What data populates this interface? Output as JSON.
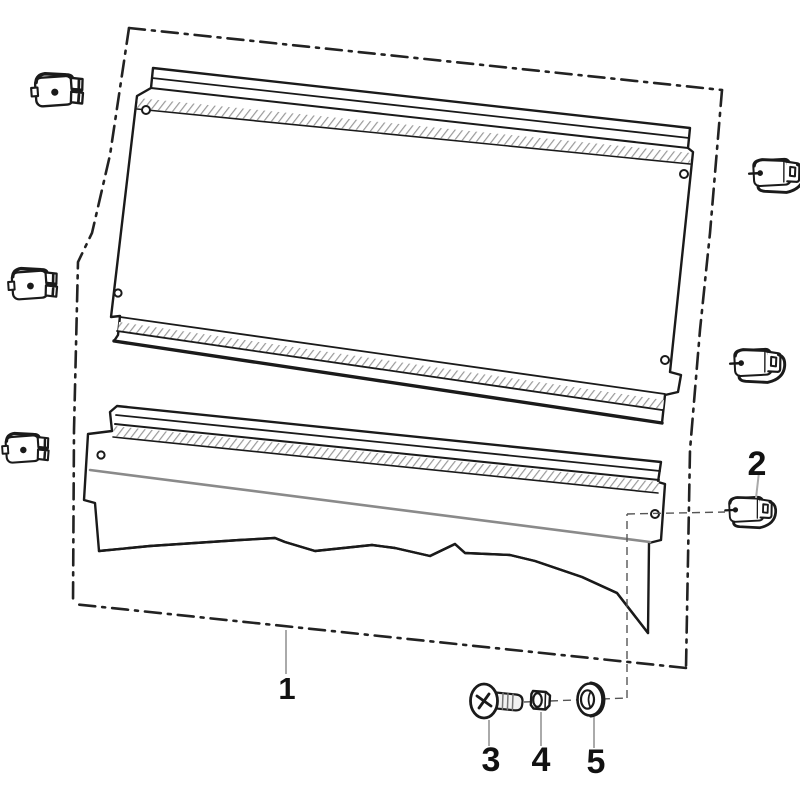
{
  "diagram": {
    "kind": "exploded-parts-diagram",
    "callouts": [
      {
        "id": "part-1",
        "label": "1"
      },
      {
        "id": "part-2",
        "label": "2"
      },
      {
        "id": "part-3",
        "label": "3"
      },
      {
        "id": "part-4",
        "label": "4"
      },
      {
        "id": "part-5",
        "label": "5"
      }
    ],
    "colors": {
      "line": "#1a1a1a",
      "hatch": "#9a9a9a",
      "gray_line": "#8a8a8a",
      "leader": "#aaaaaa",
      "dashed_leader": "#555555",
      "background": "#ffffff"
    }
  }
}
